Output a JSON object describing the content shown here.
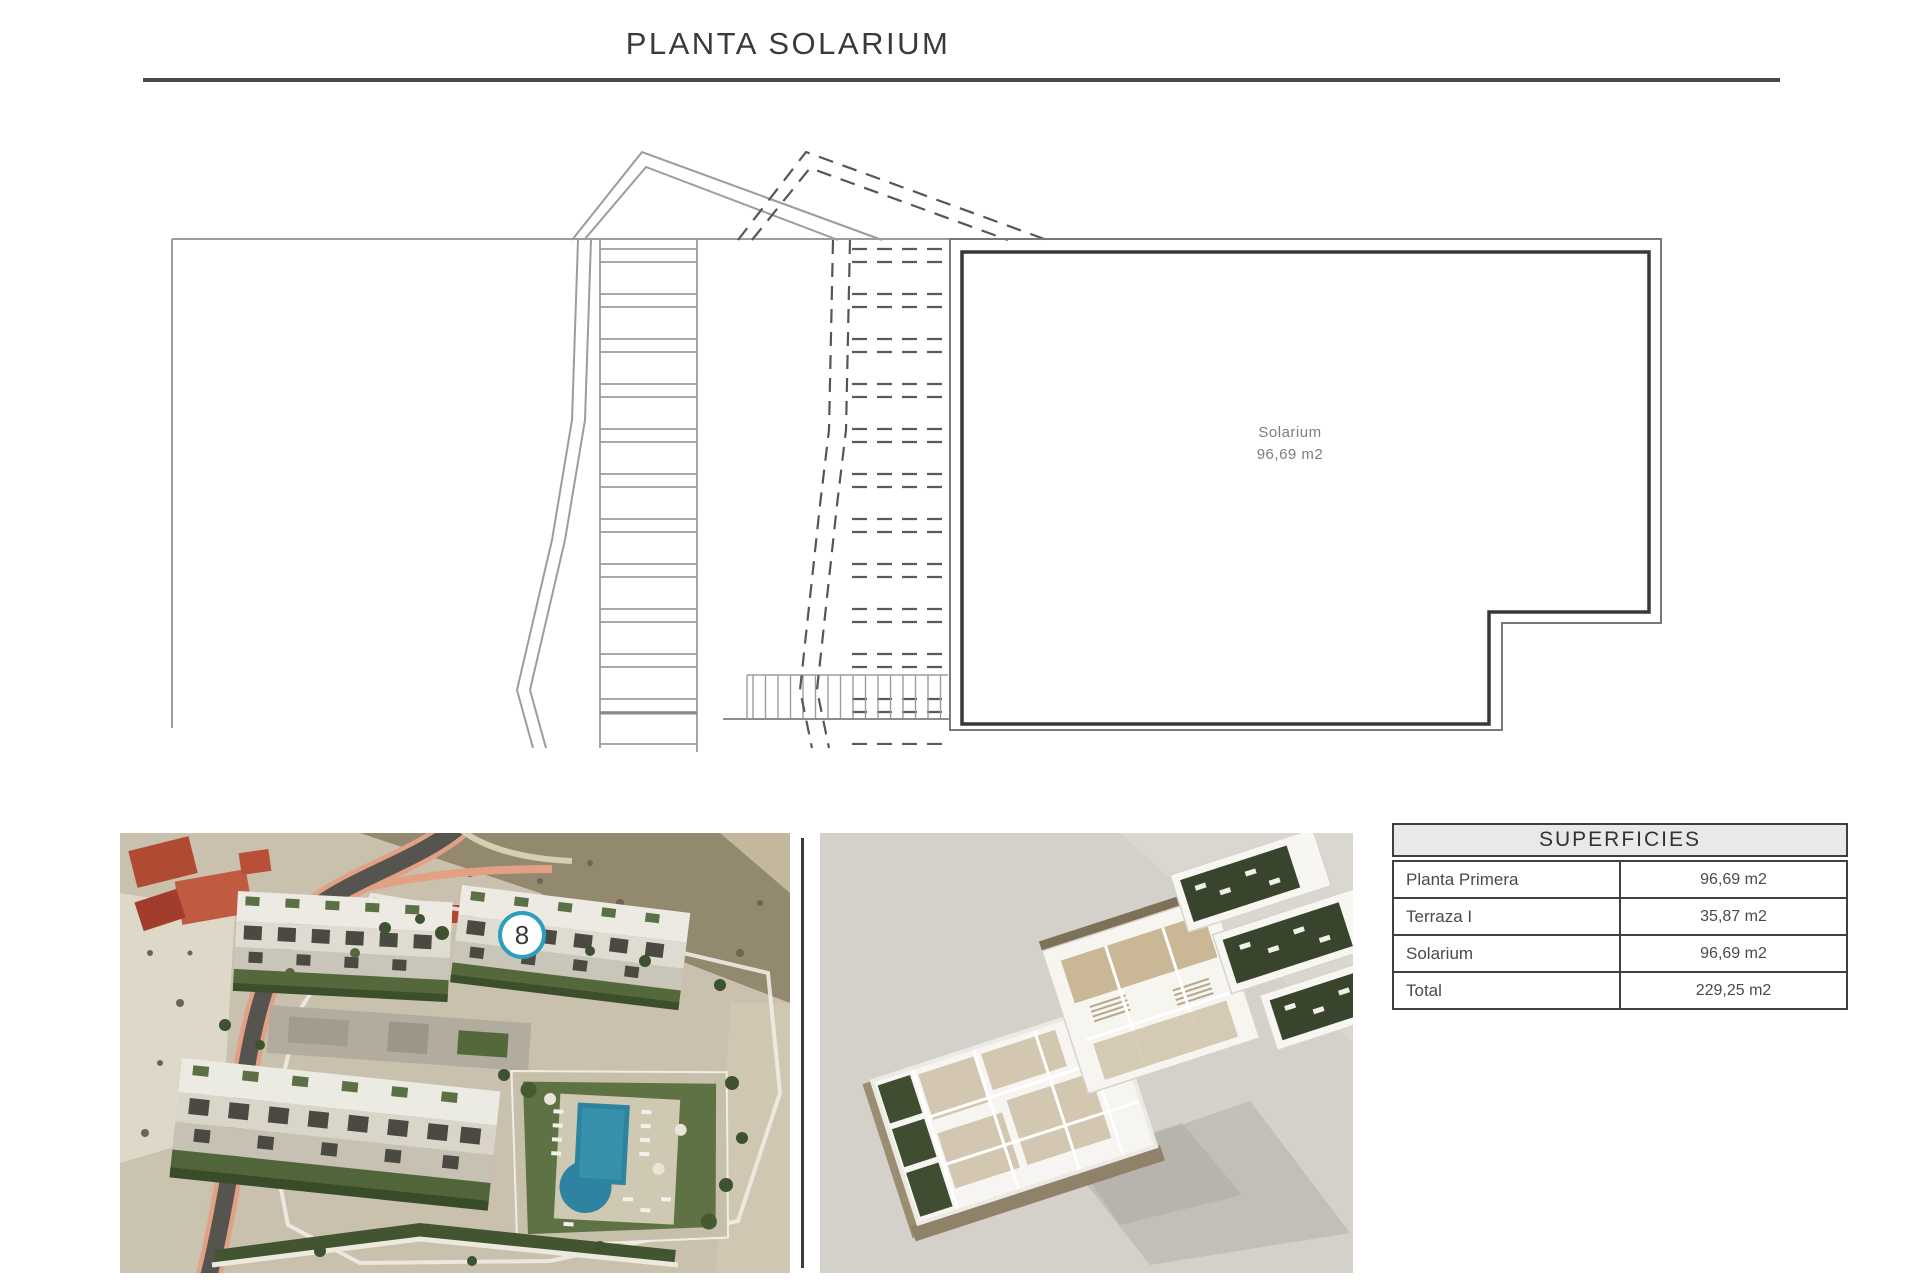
{
  "page": {
    "title": "PLANTA SOLARIUM"
  },
  "floor_plan": {
    "room": {
      "name": "Solarium",
      "area": "96,69 m2"
    }
  },
  "site_photo": {
    "unit_marker": "8"
  },
  "surfaces_table": {
    "header": "SUPERFICIES",
    "rows": [
      {
        "label": "Planta Primera",
        "value": "96,69 m2"
      },
      {
        "label": "Terraza I",
        "value": "35,87 m2"
      },
      {
        "label": "Solarium",
        "value": "96,69 m2"
      },
      {
        "label": "Total",
        "value": "229,25 m2"
      }
    ]
  },
  "colors": {
    "marker_ring": "#2b9fbd",
    "pool": "#2e84a0",
    "title_rule": "#4a4a4a",
    "table_header_bg": "#e9e9e9",
    "plan_dark_line": "#383838",
    "plan_light_line": "#9c9c9c"
  }
}
